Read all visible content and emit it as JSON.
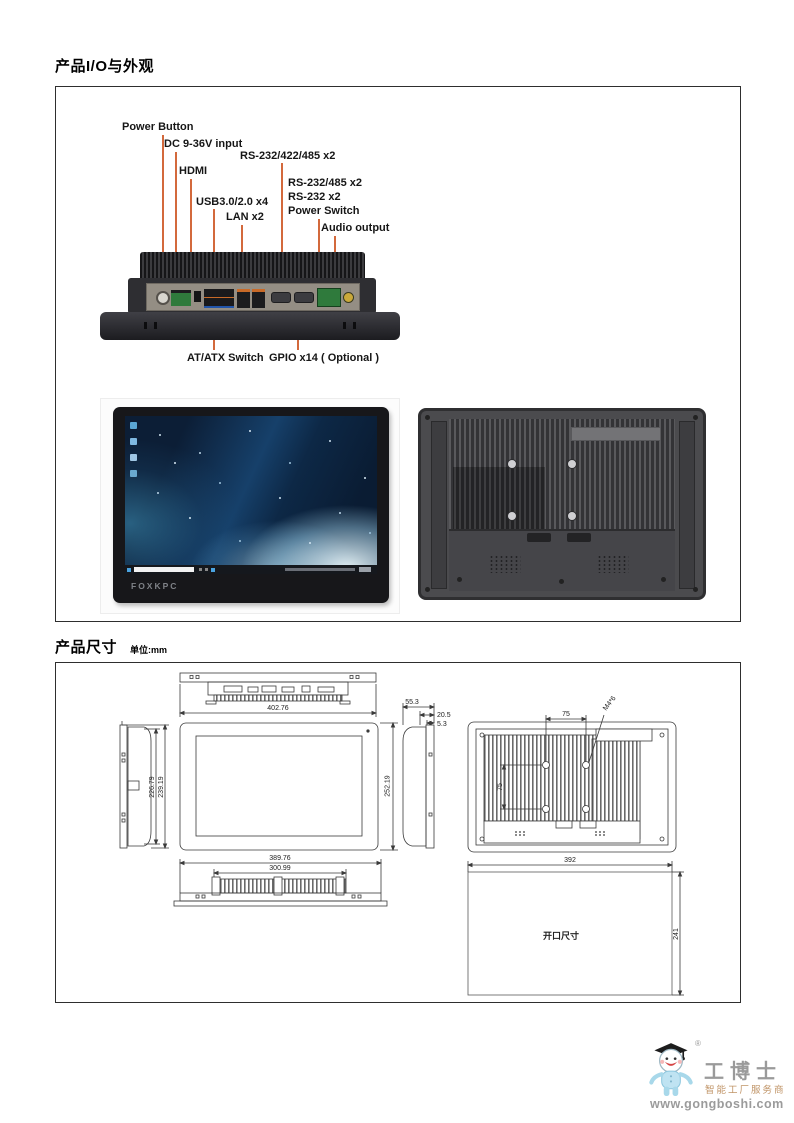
{
  "sections": {
    "io": {
      "title": "产品I/O与外观"
    },
    "dim": {
      "title": "产品尺寸",
      "unit": "单位:mm"
    }
  },
  "io_labels": {
    "power_button": "Power Button",
    "dc_input": "DC 9-36V input",
    "rs232_422_485": "RS-232/422/485 x2",
    "hdmi": "HDMI",
    "rs232_485": "RS-232/485 x2",
    "rs232_x2": "RS-232 x2",
    "power_switch": "Power Switch",
    "usb": "USB3.0/2.0 x4",
    "lan": "LAN x2",
    "audio_output": "Audio output",
    "at_atx_switch": "AT/ATX Switch",
    "gpio": "GPIO x14 ( Optional )"
  },
  "device": {
    "brand": "FOXKPC"
  },
  "dimensions": {
    "front_width": "402.76",
    "front_height": "252.19",
    "side_depth_total": "55.3",
    "side_depth_body": "20.5",
    "side_depth_bezel": "5.3",
    "side_height_inner": "226.79",
    "side_height_outer": "239.19",
    "bottom_width_outer": "389.76",
    "bottom_width_inner": "300.99",
    "vesa_horizontal": "75",
    "vesa_vertical": "75",
    "vesa_screw": "M4*6",
    "cutout_width": "392",
    "cutout_height": "241",
    "cutout_label": "开口尺寸"
  },
  "footer": {
    "brand_name": "工博士",
    "registered_mark": "®",
    "tagline": "智能工厂服务商",
    "website": "www.gongboshi.com"
  },
  "colors": {
    "leader_line": "#d3693c",
    "drawing_line": "#3a3a3a",
    "logo_gray": "#9a9a9a",
    "logo_tagline": "#c09467"
  }
}
